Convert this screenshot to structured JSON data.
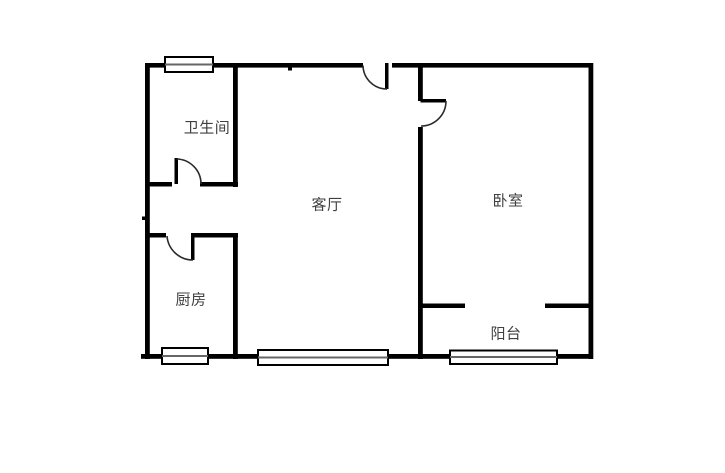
{
  "floorplan": {
    "rooms": {
      "bathroom": {
        "label": "卫生间"
      },
      "living_room": {
        "label": "客厅"
      },
      "bedroom": {
        "label": "卧室"
      },
      "kitchen": {
        "label": "厨房"
      },
      "balcony": {
        "label": "阳台"
      }
    },
    "colors": {
      "background": "#ffffff",
      "wall": "#000000",
      "door_arc": "#2a2a2a",
      "window_border": "#000000",
      "window_fill": "#ffffff",
      "window_midline": "#666666",
      "label_text": "#404040"
    }
  }
}
